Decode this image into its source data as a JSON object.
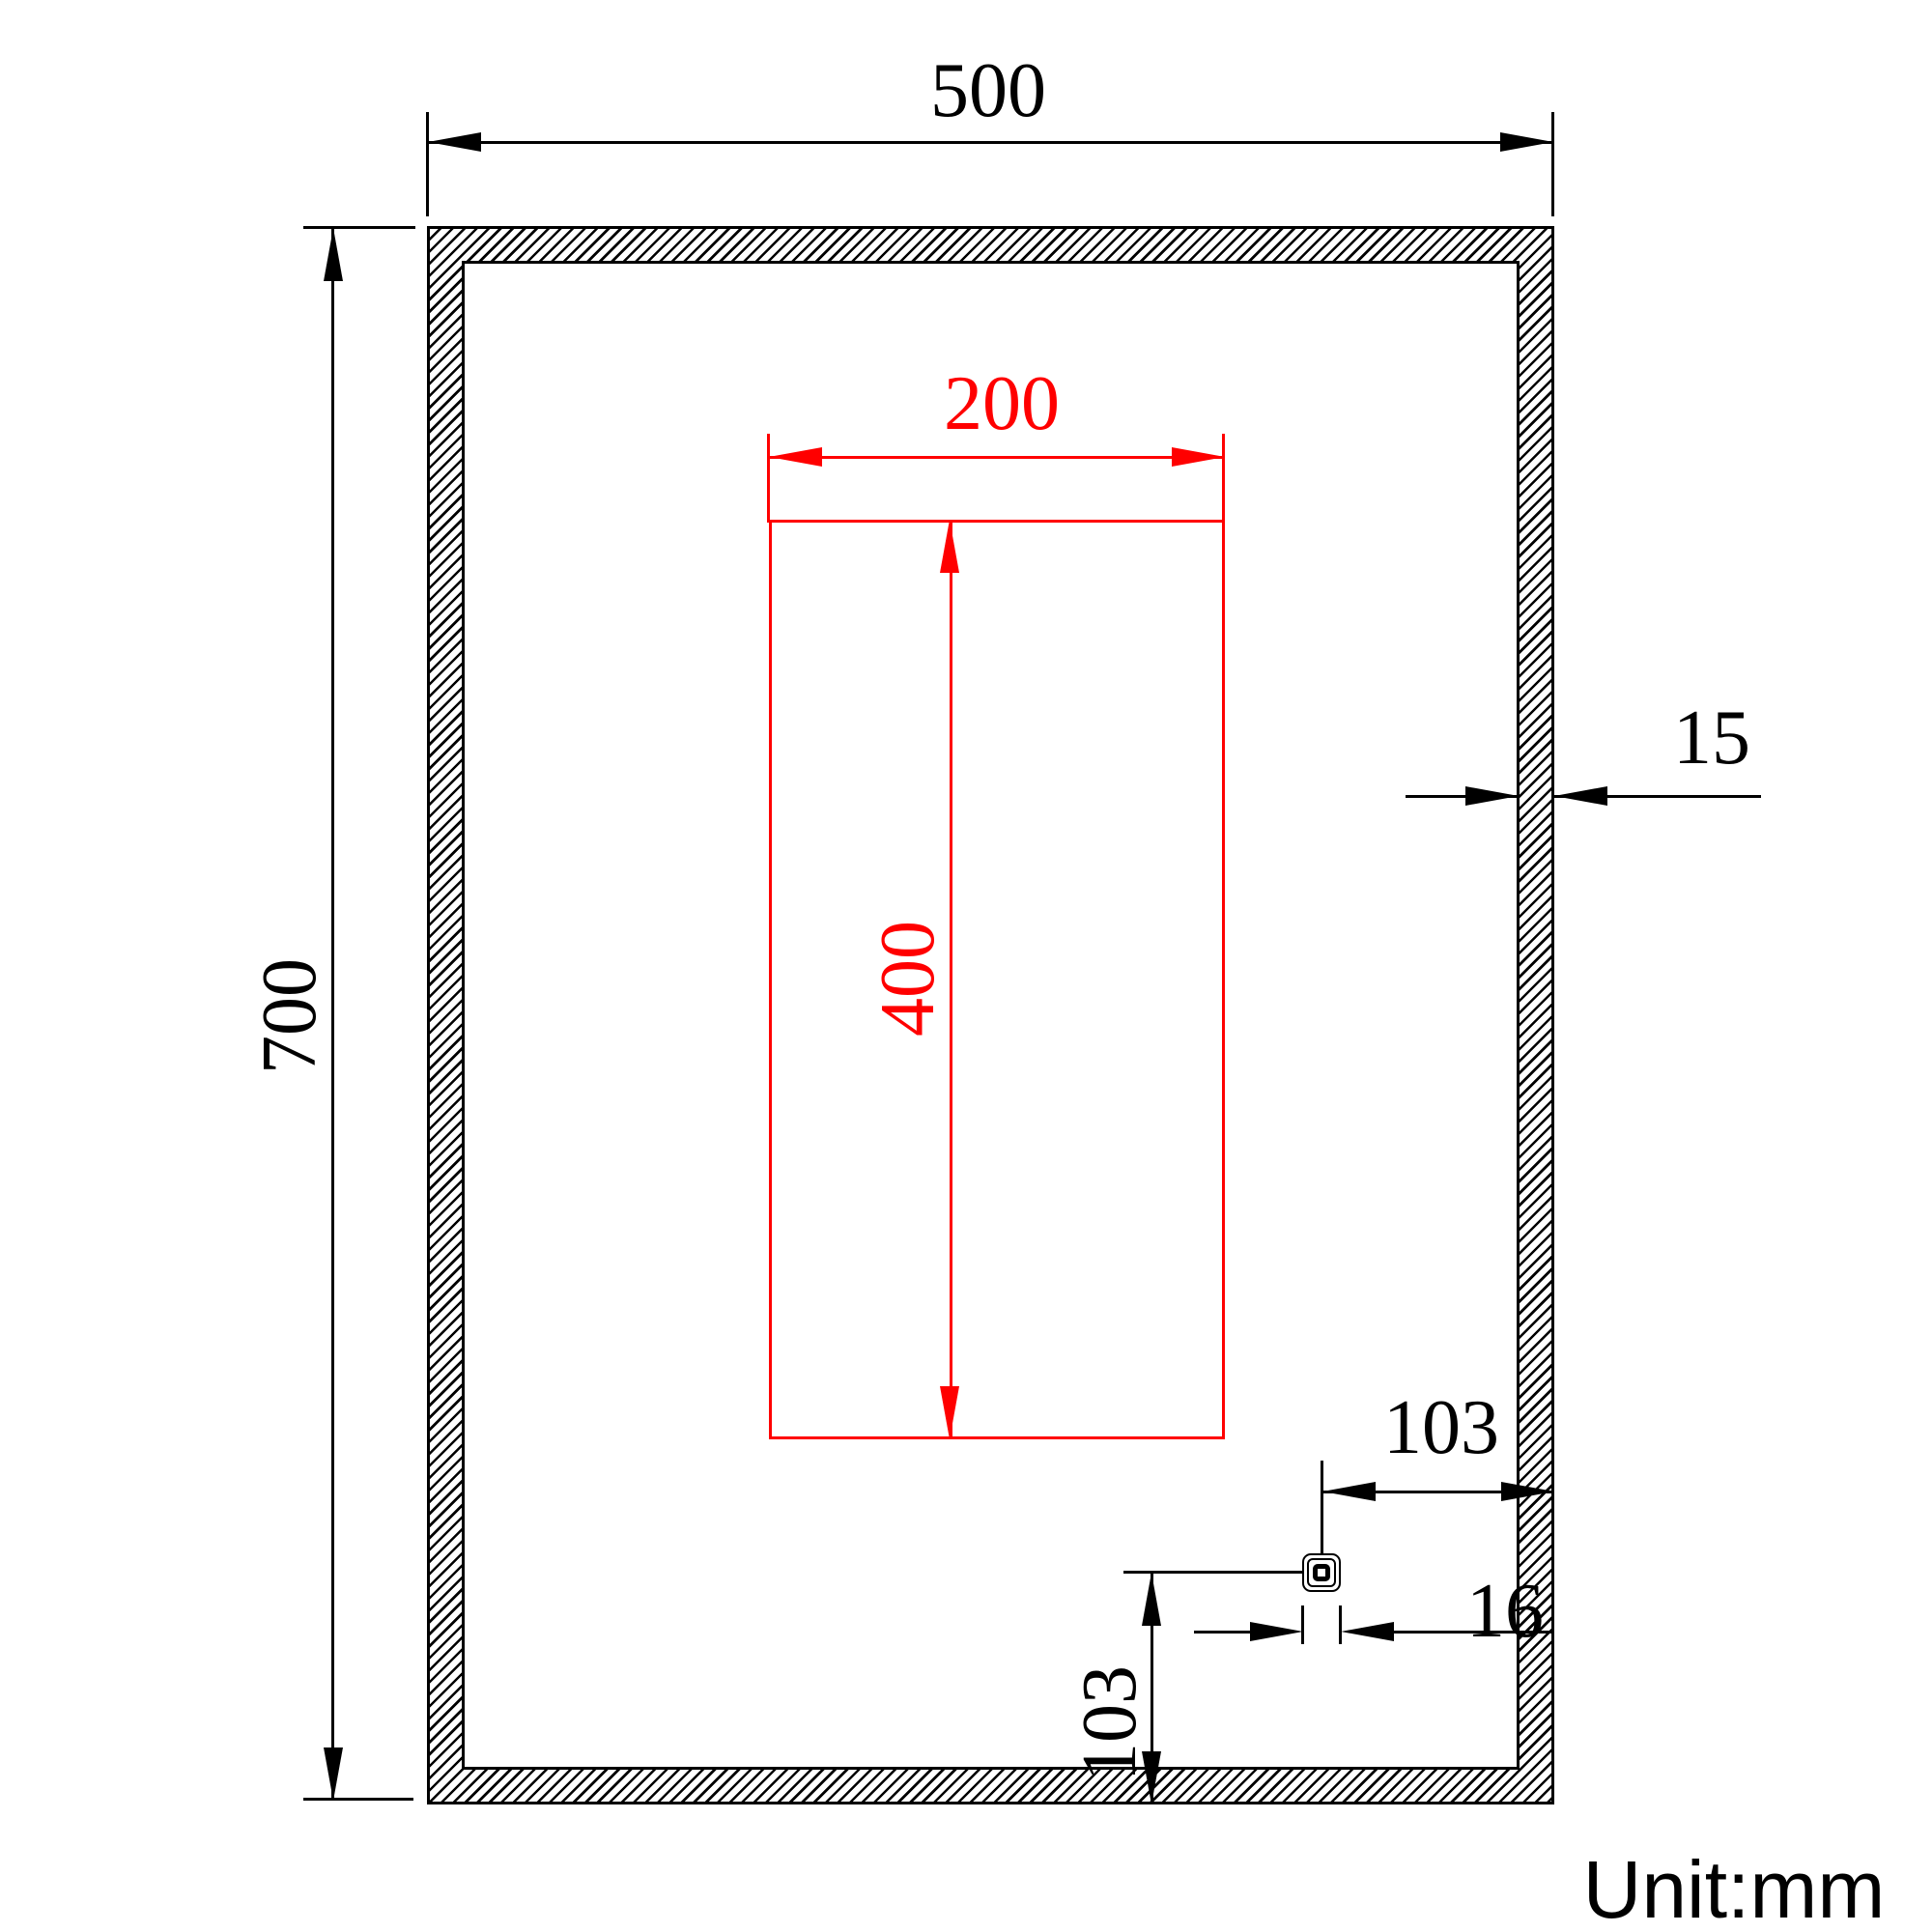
{
  "dims": {
    "outer_width": "500",
    "outer_height": "700",
    "wall_thickness": "15",
    "inner_width": "200",
    "inner_height": "400",
    "hole_offset_horizontal": "103",
    "hole_size": "16",
    "hole_offset_vertical": "103"
  },
  "note": {
    "unit": "Unit:mm"
  },
  "colors": {
    "primary_line": "#000000",
    "accent_dimension": "#ff0000",
    "background": "#ffffff"
  }
}
